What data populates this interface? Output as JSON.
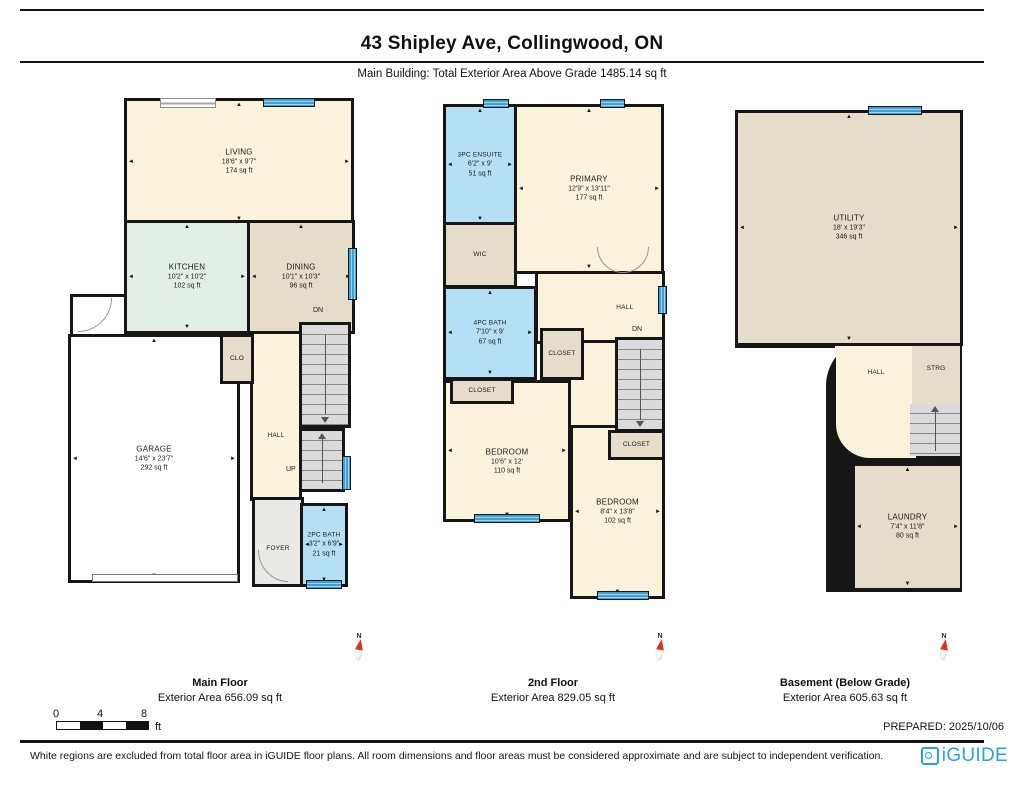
{
  "header": {
    "title": "43 Shipley Ave, Collingwood, ON",
    "subtitle": "Main Building: Total Exterior Area Above Grade 1485.14 sq ft"
  },
  "floors": [
    {
      "caption": "Main Floor",
      "caption_area": "Exterior Area 656.09 sq ft",
      "rooms": {
        "living": {
          "name": "LIVING",
          "dims": "18'6\" x 9'7\"",
          "area": "174 sq ft"
        },
        "kitchen": {
          "name": "KITCHEN",
          "dims": "10'2\" x 10'2\"",
          "area": "102 sq ft"
        },
        "dining": {
          "name": "DINING",
          "dims": "10'1\" x 10'3\"",
          "area": "96 sq ft"
        },
        "garage": {
          "name": "GARAGE",
          "dims": "14'6\" x 23'7\"",
          "area": "292 sq ft"
        },
        "clo": {
          "name": "CLO"
        },
        "hall": {
          "name": "HALL"
        },
        "foyer": {
          "name": "FOYER"
        },
        "bath2": {
          "name": "2PC BATH",
          "dims": "3'2\" x 6'9\"",
          "area": "21 sq ft"
        },
        "dn": "DN",
        "up": "UP"
      }
    },
    {
      "caption": "2nd Floor",
      "caption_area": "Exterior Area 829.05 sq ft",
      "rooms": {
        "ensuite": {
          "name": "3PC ENSUITE",
          "dims": "6'2\" x 9'",
          "area": "51 sq ft"
        },
        "primary": {
          "name": "PRIMARY",
          "dims": "12'9\" x 13'11\"",
          "area": "177 sq ft"
        },
        "wic": {
          "name": "WIC"
        },
        "bath4": {
          "name": "4PC BATH",
          "dims": "7'10\" x 9'",
          "area": "67 sq ft"
        },
        "closet_mid": {
          "name": "CLOSET"
        },
        "closet_left": {
          "name": "CLOSET"
        },
        "closet_right": {
          "name": "CLOSET"
        },
        "hall": {
          "name": "HALL"
        },
        "bedroom_left": {
          "name": "BEDROOM",
          "dims": "10'6\" x 12'",
          "area": "110 sq ft"
        },
        "bedroom_right": {
          "name": "BEDROOM",
          "dims": "8'4\" x 13'8\"",
          "area": "102 sq ft"
        },
        "dn": "DN"
      }
    },
    {
      "caption": "Basement (Below Grade)",
      "caption_area": "Exterior Area 605.63 sq ft",
      "rooms": {
        "utility": {
          "name": "UTILITY",
          "dims": "18' x 19'3\"",
          "area": "346 sq ft"
        },
        "hall": {
          "name": "HALL"
        },
        "strg": {
          "name": "STRG"
        },
        "laundry": {
          "name": "LAUNDRY",
          "dims": "7'4\" x 11'8\"",
          "area": "80 sq ft"
        },
        "up": "UP"
      }
    }
  ],
  "compass": {
    "n": "N"
  },
  "scalebar": {
    "t0": "0",
    "t1": "4",
    "t2": "8",
    "unit": "ft"
  },
  "prepared": "PREPARED: 2025/10/06",
  "footer": {
    "disclaimer": "White regions are excluded from total floor area in iGUIDE floor plans. All room dimensions and floor areas must be considered approximate and are subject to independent verification.",
    "brand": "iGUIDE"
  },
  "colors": {
    "cream": "#FBF2DB",
    "mint": "#E3EEE6",
    "tan": "#E5DCCA",
    "bath_blue": "#B4DFF4",
    "stair_gray": "#DADADA",
    "foyer_gray": "#E9E9E8",
    "wall": "#161616",
    "window_blue": "#3D9FD6",
    "brand_blue": "#2BA2DC",
    "compass_red": "#DF3022"
  }
}
